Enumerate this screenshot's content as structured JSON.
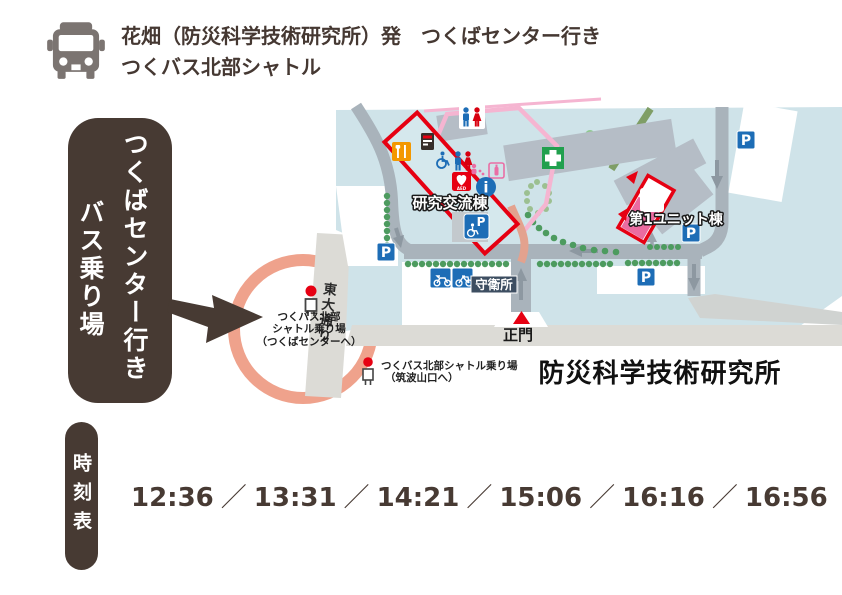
{
  "header": {
    "line1": "花畑（防災科学技術研究所）発　つくばセンター行き",
    "line2": "つくバス北部シャトル"
  },
  "boarding_label": {
    "line1": "つくばセンター行き",
    "line2": "バス乗り場"
  },
  "map": {
    "facility_name": "防災科学技術研究所",
    "road_name": "東大通り",
    "main_gate_label": "正門",
    "guard_office_label": "守衛所",
    "building_koryu_label": "研究交流棟",
    "building_unit1_label": "第1ユニット棟",
    "bus_stop_center": {
      "line1": "つくバス北部",
      "line2": "シャトル乗り場",
      "line3": "（つくばセンターへ）"
    },
    "bus_stop_tsukubasan": {
      "line1": "つくバス北部シャトル乗り場",
      "line2": "（筑波山口へ）"
    },
    "parking_label": "P",
    "info_label": "i",
    "aed_label": "AED"
  },
  "timetable": {
    "label": "時刻表",
    "separator": "／",
    "times": [
      "12:36",
      "13:31",
      "14:21",
      "15:06",
      "16:16",
      "16:56"
    ]
  },
  "colors": {
    "dark_brown": "#473a33",
    "highlight_ring": "#efa28c",
    "campus_blue": "#cfe3e9",
    "building_gray": "#b5bdc6",
    "road_gray": "#a9b3bb",
    "outer_road_gray": "#dcdbd6",
    "red": "#e60012",
    "pink_building": "#eb6ba0",
    "parking_blue": "#1d6db6",
    "tree_green": "#4d9b5f"
  }
}
